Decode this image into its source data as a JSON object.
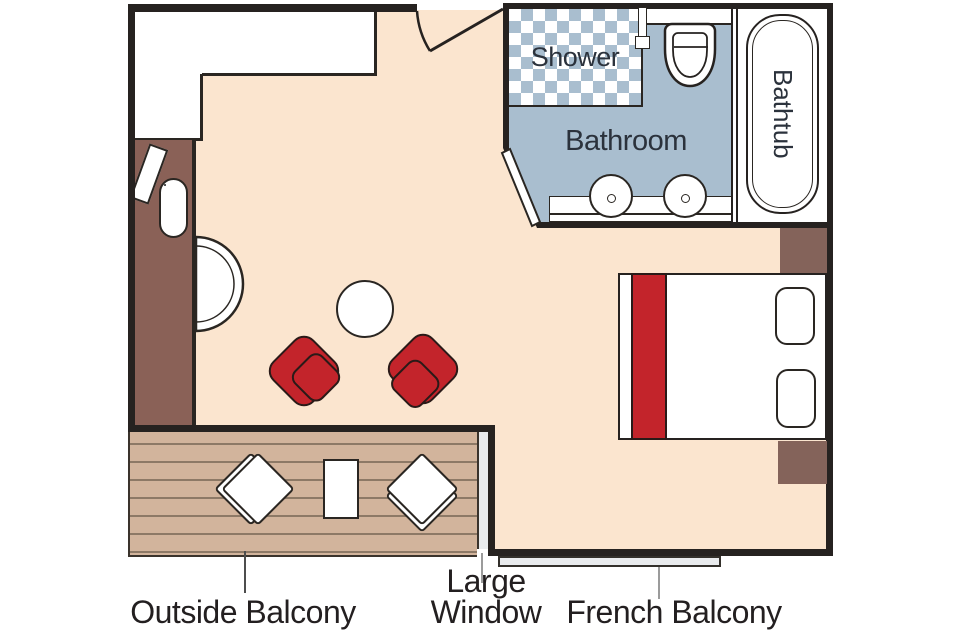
{
  "rooms": {
    "shower_label": "Shower",
    "bathroom_label": "Bathroom",
    "bathtub_label": "Bathtub"
  },
  "annotations": {
    "outside_balcony": "Outside Balcony",
    "large_window_line1": "Large",
    "large_window_line2": "Window",
    "french_balcony": "French Balcony"
  },
  "colors": {
    "floor": "#fbe5cf",
    "wall": "#262220",
    "outline": "#2a2622",
    "wood": "#8a6157",
    "nstand": "#84635a",
    "deck": "#d2b49c",
    "plank": "#8d7966",
    "bath": "#a9becf",
    "red": "#c3242b",
    "glass": "#e9ebed",
    "text": "#231f20",
    "roomtext": "#2b323c"
  }
}
